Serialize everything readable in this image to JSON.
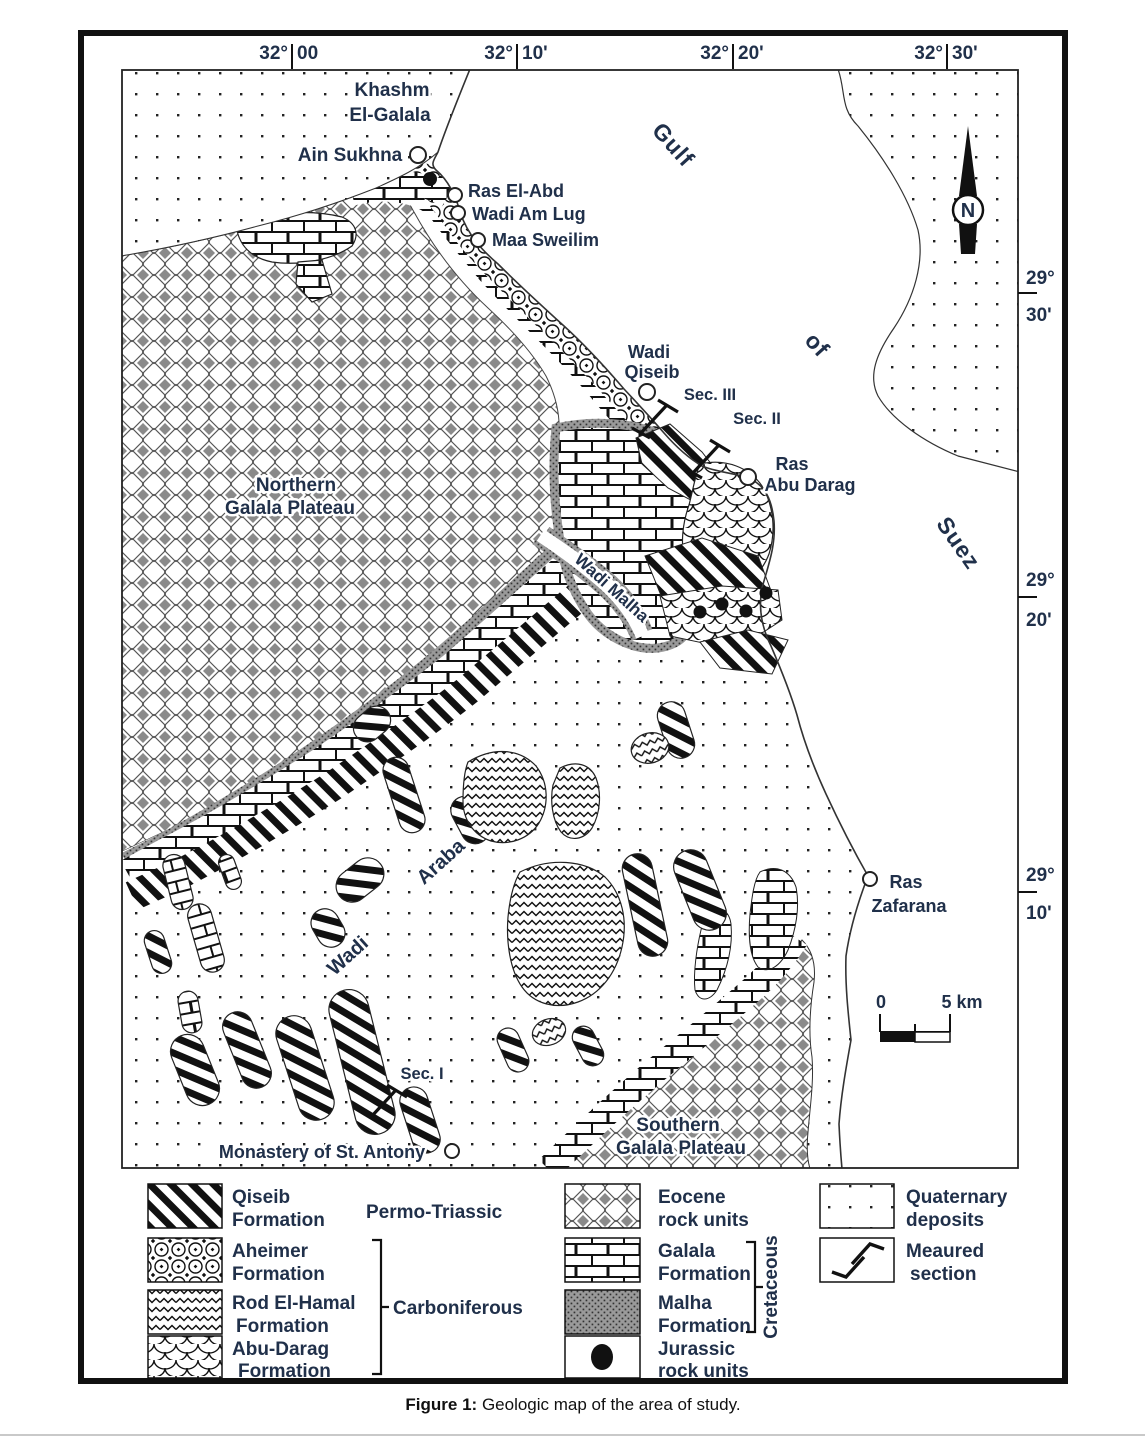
{
  "colors": {
    "label": "#20304a",
    "ink": "#111111",
    "frame": "#111111"
  },
  "map": {
    "top_coords": [
      {
        "deg": "32°",
        "min": "00"
      },
      {
        "deg": "32°",
        "min": "10'"
      },
      {
        "deg": "32°",
        "min": "20'"
      },
      {
        "deg": "32°",
        "min": "30'"
      }
    ],
    "right_coords": [
      {
        "deg": "29°",
        "min": "30'"
      },
      {
        "deg": "29°",
        "min": "20'"
      },
      {
        "deg": "29°",
        "min": "10'"
      }
    ],
    "sea": {
      "word1": "Gulf",
      "word2": "of",
      "word3": "Suez"
    },
    "places": {
      "khashm": [
        "Khashm",
        "El-Galala"
      ],
      "ain_sukhna": "Ain Sukhna",
      "ras_el_abd": "Ras El-Abd",
      "wadi_am_lug": "Wadi Am Lug",
      "maa_sweilim": "Maa Sweilim",
      "wadi_qiseib": [
        "Wadi",
        "Qiseib"
      ],
      "sec3": "Sec. III",
      "sec2": "Sec. II",
      "sec1": "Sec. I",
      "ras_abu_darag": [
        "Ras",
        "Abu Darag"
      ],
      "northern": [
        "Northern",
        "Galala Plateau"
      ],
      "wadi_malha": "Wadi  Malha",
      "wadi_araba": {
        "w1": "Wadi",
        "w2": "Araba"
      },
      "ras_zafarana": [
        "Ras",
        "Zafarana"
      ],
      "monastery": "Monastery of St. Antony",
      "southern": [
        "Southern",
        "Galala Plateau"
      ]
    },
    "north_label": "N",
    "scale": {
      "start": "0",
      "end": "5 km"
    }
  },
  "legend": {
    "rows_left": [
      {
        "name": "qiseib",
        "pattern": "diagonal-stripes",
        "lines": [
          "Qiseib",
          "Formation"
        ]
      },
      {
        "name": "aheimer",
        "pattern": "circle-lattice",
        "lines": [
          "Aheimer",
          "Formation"
        ]
      },
      {
        "name": "rod_el_hamal",
        "pattern": "wave-lines",
        "lines": [
          "Rod El-Hamal",
          "Formation"
        ]
      },
      {
        "name": "abu_darag",
        "pattern": "fish-scales",
        "lines": [
          "Abu-Darag",
          "Formation"
        ]
      }
    ],
    "rows_mid": [
      {
        "name": "eocene",
        "pattern": "diamond-lattice",
        "lines": [
          "Eocene",
          "rock units"
        ]
      },
      {
        "name": "galala",
        "pattern": "brick",
        "lines": [
          "Galala",
          "Formation"
        ]
      },
      {
        "name": "malha",
        "pattern": "dense-hatch",
        "lines": [
          "Malha",
          "Formation"
        ]
      },
      {
        "name": "jurassic",
        "pattern": "black-dot",
        "lines": [
          "Jurassic",
          "rock units"
        ]
      }
    ],
    "rows_right": [
      {
        "name": "quaternary",
        "pattern": "sparse-dots",
        "lines": [
          "Quaternary",
          "deposits"
        ]
      },
      {
        "name": "measured",
        "pattern": "measured-section-symbol",
        "lines": [
          "Meaured",
          "section"
        ]
      }
    ],
    "groups": {
      "permo": "Permo-Triassic",
      "carboniferous": "Carboniferous",
      "cretaceous": "Cretaceous"
    }
  },
  "caption": {
    "prefix": "Figure 1:",
    "text": " Geologic map of the area of study."
  }
}
